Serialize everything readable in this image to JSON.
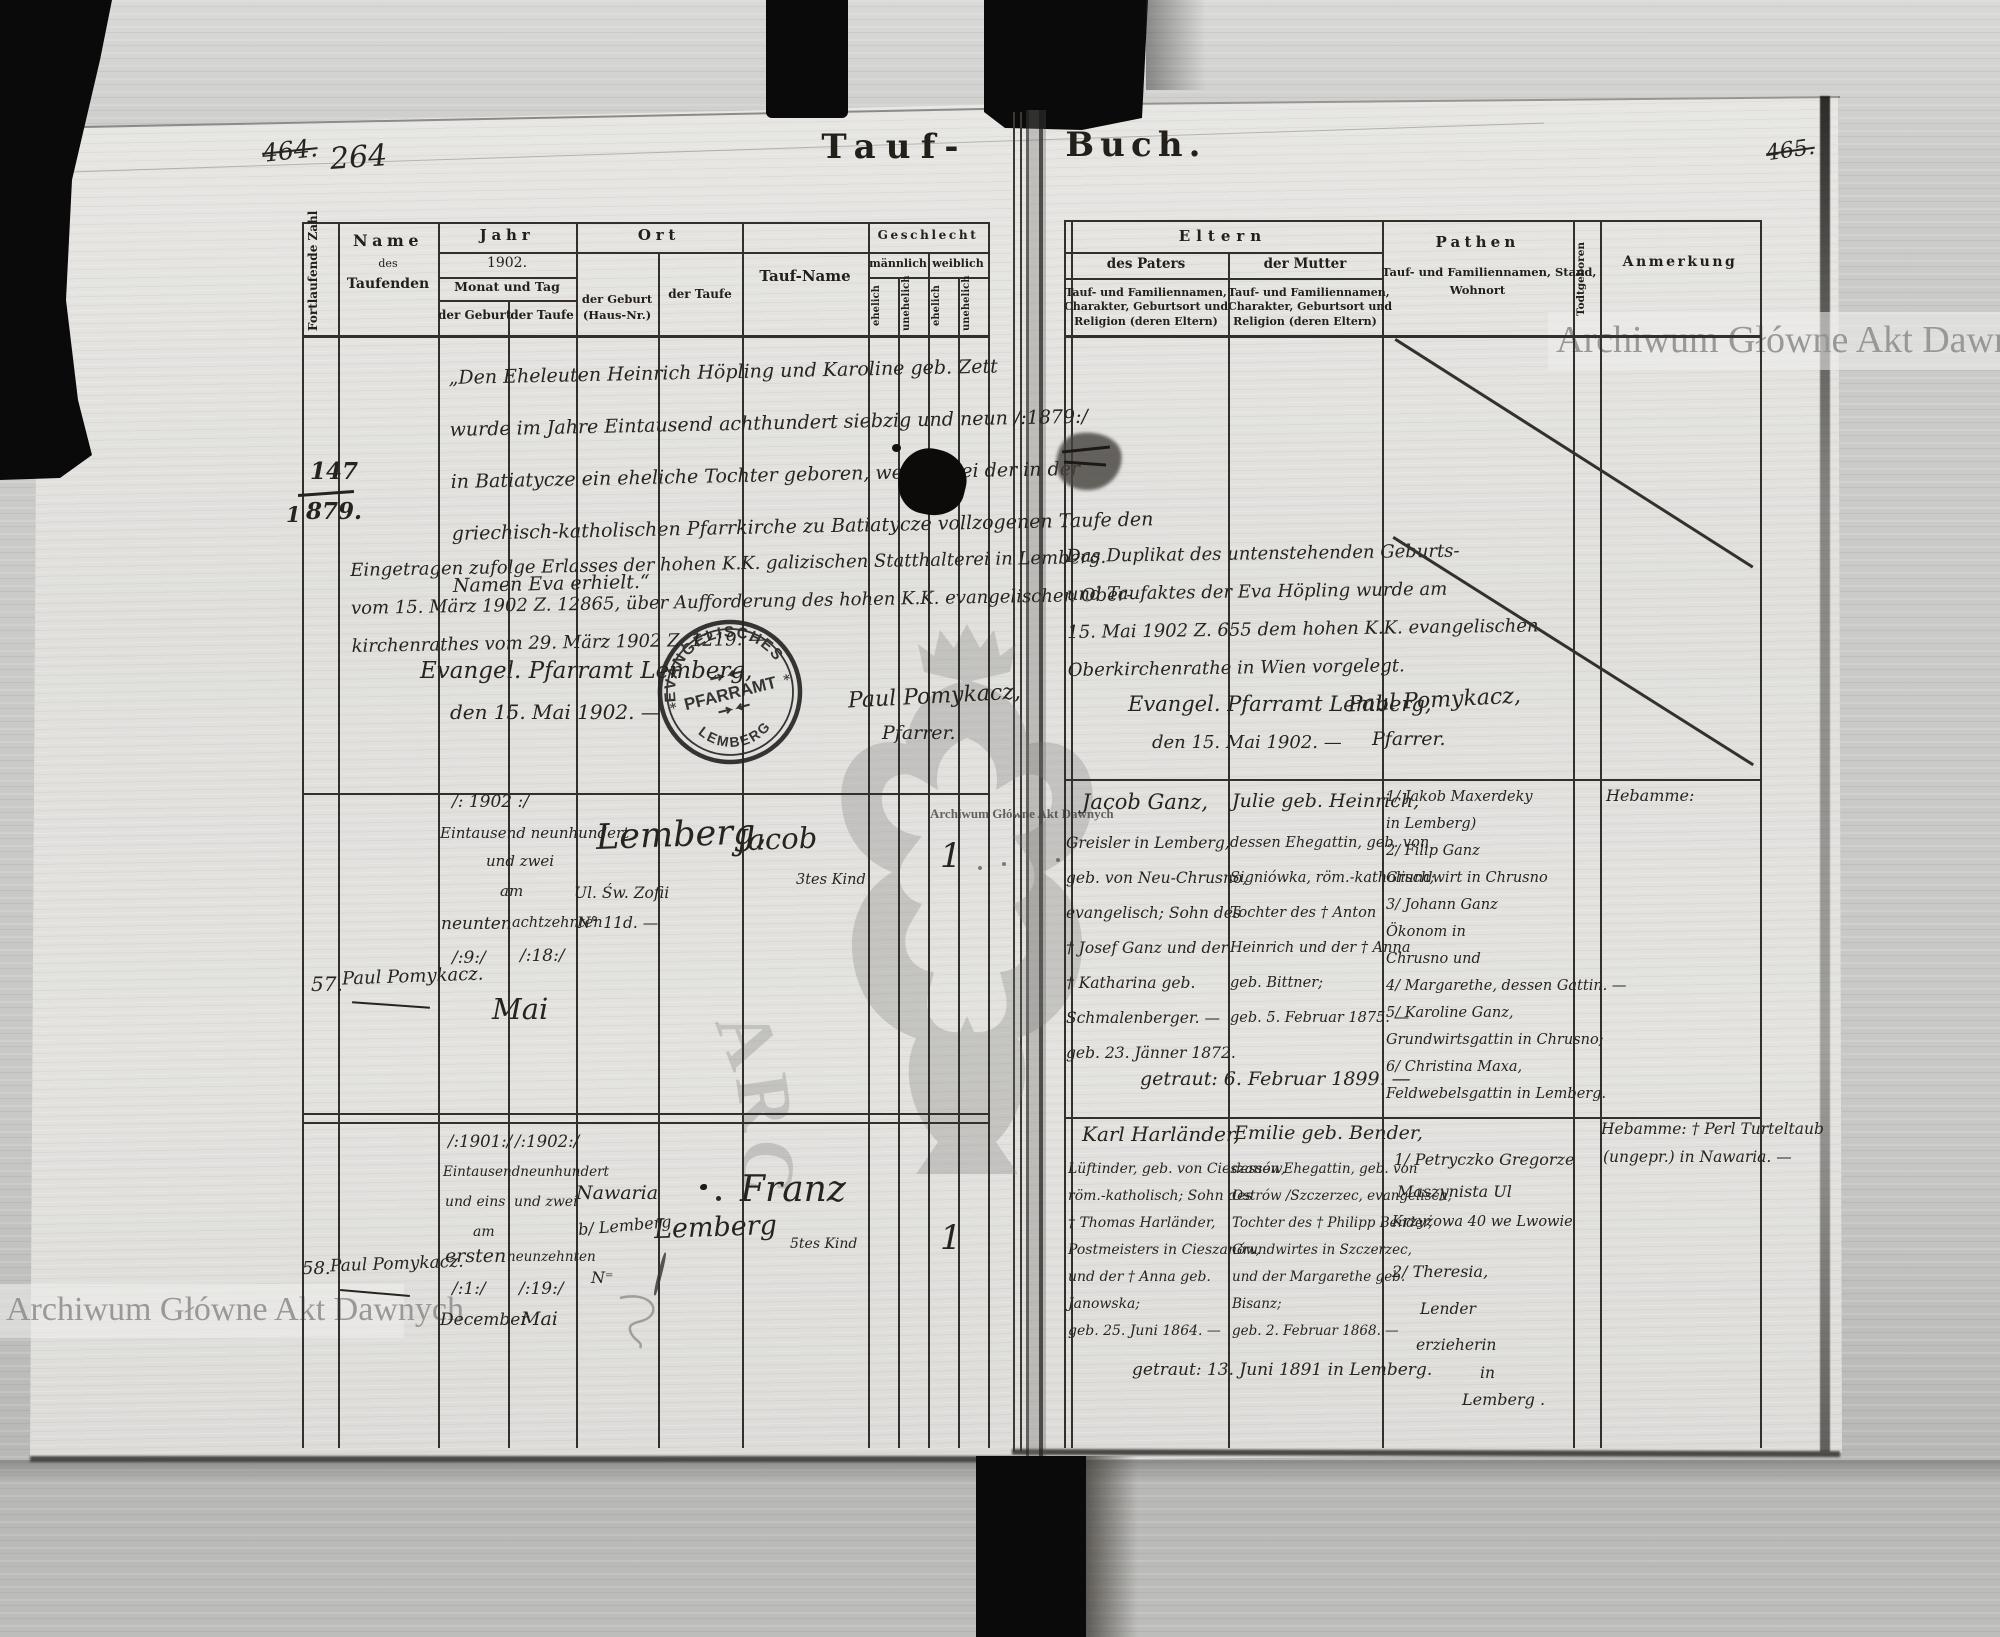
{
  "titles": {
    "left": "Tauf-",
    "right": "Buch."
  },
  "page_numbers": {
    "left_old": "464.",
    "left_new": "264",
    "right_old": "465."
  },
  "watermarks": {
    "band": "Archiwum Główne Akt Dawnych",
    "tiny": "Archiwum Główne Akt Dawnych",
    "circle": "ARCHIWUM GŁÓWNE AKT DAWNYCH"
  },
  "stamp": {
    "arc_top": "EVANGELISCHES",
    "center": "PFARRAMT",
    "arc_bottom": "LEMBERG",
    "star": "*"
  },
  "left_headers": {
    "col_zahl": "Fortlaufende Zahl",
    "name_1": "Name",
    "name_2": "des",
    "name_3": "Taufenden",
    "jahr": "Jahr",
    "jahr_year": "1902.",
    "monat": "Monat und Tag",
    "geburt": "der Geburt",
    "taufe": "der Taufe",
    "ort": "Ort",
    "ort_geburt": [
      "der Geburt",
      "(Haus-Nr.)"
    ],
    "ort_taufe": "der Taufe",
    "taufname": "Tauf-Name",
    "geschlecht": "Geschlecht",
    "maennlich": "männlich",
    "weiblich": "weiblich",
    "ehelich": "ehelich",
    "unehelich": "unehelich"
  },
  "right_headers": {
    "eltern": "Eltern",
    "paters": "des Paters",
    "mutter": "der Mutter",
    "eltern_desc": [
      "Tauf- und Familiennamen,",
      "Charakter, Geburtsort und",
      "Religion (deren Eltern)"
    ],
    "pathen": "Pathen",
    "pathen_desc": [
      "Tauf- und Familiennamen, Stand,",
      "Wohnort"
    ],
    "todtgeboren": "Todtgeboren",
    "anmerkung": "Anmerkung"
  },
  "row1": {
    "number_top": "147",
    "number_bottom": "879.",
    "number_side": "1",
    "quote": [
      "„Den Eheleuten Heinrich Höpling und Karoline geb. Zett",
      "wurde im Jahre Eintausend achthundert siebzig und neun /:1879:/",
      "in Batiatycze ein eheliche Tochter geboren, welche bei der in der",
      "griechisch-katholischen Pfarrkirche zu Batiatycze vollzogenen Taufe den",
      "Namen Eva erhielt.“"
    ],
    "registration": [
      "Eingetragen zufolge Erlasses der hohen K.K. galizischen Statthalterei in Lemberg.",
      "vom 15. März 1902 Z. 12865, über Aufforderung des hohen K.K. evangelischen Ober-",
      "kirchenrathes vom 29. März 1902 Z. 1219. —"
    ],
    "closing_1": "Evangel. Pfarramt Lemberg,",
    "closing_2": "den 15. Mai 1902. —",
    "signature_1": "Paul Pomykacz,",
    "signature_2": "Pfarrer.",
    "right_note": [
      "Das Duplikat des untenstehenden Geburts-",
      "und Taufaktes der Eva Höpling wurde am",
      "15. Mai 1902 Z. 655 dem hohen K.K. evangelischen",
      "Oberkirchenrathe in Wien vorgelegt."
    ],
    "right_closing_1": "Evangel. Pfarramt Lemberg,",
    "right_closing_2": "den 15. Mai 1902. —",
    "right_signature_1": "Paul Pomykacz,",
    "right_signature_2": "Pfarrer."
  },
  "row57": {
    "number": "57.",
    "name": "Paul Pomykacz.",
    "year": "/: 1902 :/",
    "year_words_1": "Eintausend neunhundert",
    "year_words_2": "und zwei",
    "am": "am",
    "day_geburt_word": "neunten",
    "day_taufe_word": "achtzehnten",
    "day_geburt": "/:9:/",
    "day_taufe": "/:18:/",
    "month": "Mai",
    "ort_city": "Lemberg,",
    "ort_street_1": "Ul. Św. Zofii",
    "ort_street_2": "N° 11d. —",
    "taufname": "Jacob",
    "kind": "3tes Kind",
    "geschlecht_mark": "1",
    "vater_name": "Jacob Ganz,",
    "vater": [
      "Greisler in Lemberg,",
      "geb. von Neu-Chrusno,",
      "evangelisch; Sohn des",
      "† Josef Ganz und der",
      "† Katharina geb.",
      "Schmalenberger. —",
      "geb. 23. Jänner 1872."
    ],
    "mutter_name": "Julie geb. Heinrich,",
    "mutter": [
      "dessen Ehegattin, geb. von",
      "Signiówka, röm.-katholisch;",
      "Tochter des † Anton",
      "Heinrich und der † Anna",
      "geb. Bittner;",
      "geb. 5. Februar 1875. —"
    ],
    "getraut": "getraut: 6. Februar 1899. —",
    "pathen": [
      "1/ Jakob Maxerdeky",
      "in Lemberg)",
      "2/ Filip Ganz",
      "Grundwirt in Chrusno",
      "3/ Johann Ganz",
      "Ökonom in",
      "Chrusno und",
      "4/ Margarethe, dessen Gattin. —",
      "5/ Karoline Ganz,",
      "Grundwirtsgattin in Chrusno;",
      "6/ Christina Maxa,",
      "Feldwebelsgattin in Lemberg."
    ],
    "anmerkung": "Hebamme:"
  },
  "row58": {
    "number": "58.",
    "name": "Paul Pomykacz.",
    "year_geburt": "/:1901:/",
    "year_taufe": "/:1902:/",
    "year_words": "Eintausendneunhundert",
    "year_words_geburt": "und eins",
    "year_words_taufe": "und zwei",
    "am": "am",
    "day_geburt_word": "ersten",
    "day_taufe_word": "neunzehnten",
    "day_geburt": "/:1:/",
    "day_taufe": "/:19:/",
    "month_geburt": "December",
    "month_taufe": "Mai",
    "ort_geburt_1": "Nawaria",
    "ort_geburt_2": "b/ Lemberg",
    "ort_geburt_3": "N⁼",
    "ort_taufe": "Lemberg",
    "taufname": "Franz",
    "kind": "5tes Kind",
    "geschlecht_mark": "1",
    "vater_name": "Karl Harländer,",
    "vater": [
      "Lüftinder, geb. von Cieszanów,",
      "röm.-katholisch; Sohn des",
      "† Thomas Harländer,",
      "Postmeisters in Cieszanów,",
      "und der † Anna geb.",
      "Janowska;",
      "geb. 25. Juni 1864. —"
    ],
    "mutter_name": "Emilie geb. Bender,",
    "mutter": [
      "dessen Ehegattin, geb. von",
      "Ostrów /Szczerzec, evangelisch;",
      "Tochter des † Philipp Bender,",
      "Grundwirtes in Szczerzec,",
      "und der Margarethe geb.",
      "Bisanz;",
      "geb. 2. Februar 1868. —"
    ],
    "getraut": "getraut: 13. Juni 1891 in Lemberg.",
    "pathen_1": "1/ Petryczko Gregorze",
    "pathen_2": "Maszynista Ul",
    "pathen_3": "Krzyżowa 40 we Lwowie",
    "pathen_4": "2/ Theresia,",
    "pathen_5": "Lender",
    "pathen_6": "erzieherin",
    "pathen_7": "in",
    "pathen_8": "Lemberg .",
    "anmerkung_1": "Hebamme: † Perl Turteltaub",
    "anmerkung_2": "(ungepr.) in Nawaria. —"
  }
}
